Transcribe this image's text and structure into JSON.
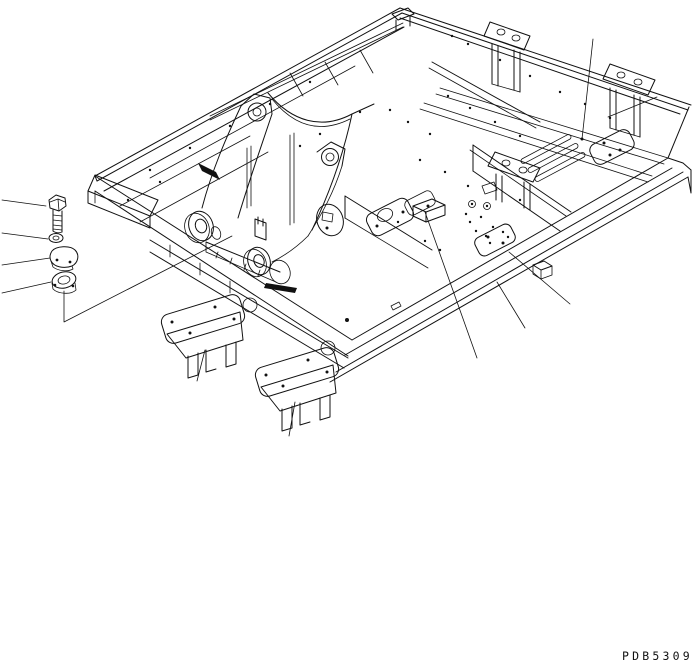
{
  "page": {
    "background_color": "#ffffff",
    "line_color": "#111111"
  },
  "diagram": {
    "type": "isometric-parts-drawing",
    "subject": "main-frame-assembly",
    "part_number": "PDB5309",
    "hardware_parts": [
      {
        "name": "mounting-bolt"
      },
      {
        "name": "washer"
      },
      {
        "name": "cover-plate"
      },
      {
        "name": "ring-flange"
      }
    ]
  }
}
